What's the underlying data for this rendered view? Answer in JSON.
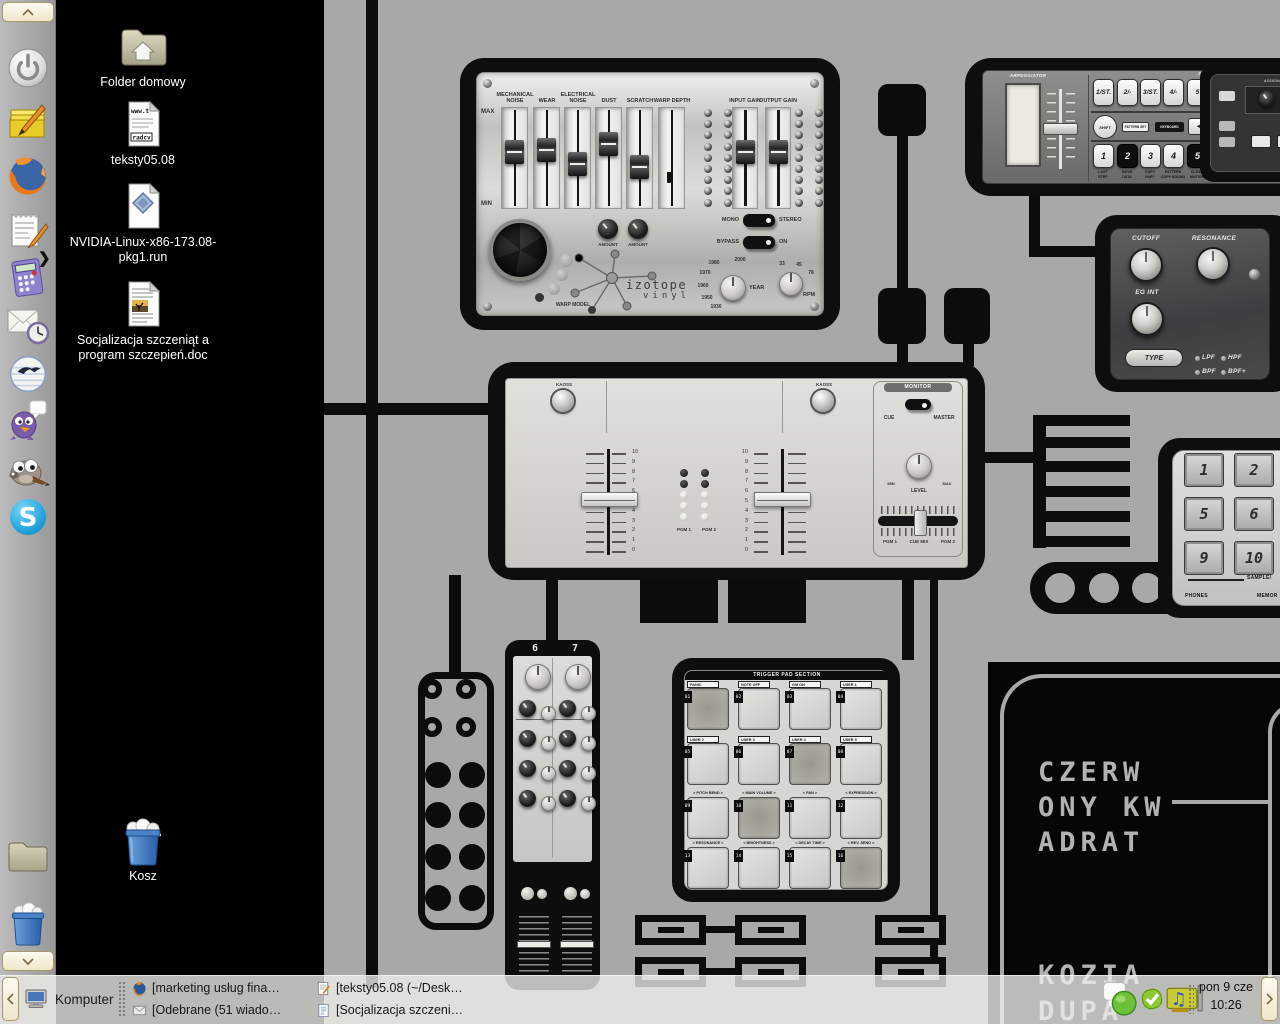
{
  "desktop": {
    "icons": [
      {
        "label": "Folder domowy",
        "icon": "folder-home-icon"
      },
      {
        "label": "teksty05.08",
        "icon": "text-file-icon",
        "preview_top": "www.t",
        "preview_bottom": "radcv"
      },
      {
        "label": "NVIDIA-Linux-x86-173.08-pkg1.run",
        "icon": "installer-file-icon"
      },
      {
        "label": "Socjalizacja szczeniąt a program szczepień.doc",
        "icon": "doc-file-icon"
      },
      {
        "label": "Kosz",
        "icon": "trash-full-icon"
      }
    ]
  },
  "side_panel": {
    "items": [
      {
        "icon": "power-icon"
      },
      {
        "icon": "sticky-notes-icon"
      },
      {
        "icon": "firefox-icon"
      },
      {
        "icon": "notepad-icon"
      },
      {
        "icon": "calculator-icon"
      },
      {
        "icon": "mail-clock-icon"
      },
      {
        "icon": "openoffice-icon"
      },
      {
        "icon": "pidgin-icon"
      },
      {
        "icon": "gimp-icon"
      },
      {
        "icon": "skype-icon"
      },
      {
        "icon": "folder-icon"
      },
      {
        "icon": "trash-icon"
      }
    ]
  },
  "taskbar": {
    "menu_label": "Komputer",
    "tasks": [
      {
        "icon": "firefox-icon",
        "label": "[marketing usług fina…"
      },
      {
        "icon": "editor-icon",
        "label": "[teksty05.08 (~/Desk…"
      },
      {
        "icon": "mail-icon",
        "label": "[Odebrane (51 wiado…"
      },
      {
        "icon": "document-icon",
        "label": "[Socjalizacja szczeni…"
      }
    ],
    "tray_icons": [
      "messenger-status-icon",
      "skype-status-icon",
      "soundcard-icon"
    ],
    "clock": {
      "date": "pon 9 cze",
      "time": "10:26"
    }
  },
  "wallpaper": {
    "vinyl": {
      "max_label": "MAX",
      "min_label": "MIN",
      "sliders": [
        {
          "label": "MECHANICAL NOISE",
          "pos": 44
        },
        {
          "label": "WEAR",
          "pos": 42
        },
        {
          "label": "ELECTRICAL NOISE",
          "pos": 56
        },
        {
          "label": "DUST",
          "pos": 36
        },
        {
          "label": "SCRATCH",
          "pos": 59
        },
        {
          "label": "WARP DEPTH",
          "pos": 64,
          "no_handle": true
        }
      ],
      "gain_sliders": [
        {
          "label": "INPUT GAIN",
          "pos": 44
        },
        {
          "label": "OUTPUT GAIN",
          "pos": 44
        }
      ],
      "mono_label": "MONO",
      "stereo_label": "STEREO",
      "bypass_label": "BYPASS",
      "on_label": "ON",
      "amount_label": "AMOUNT",
      "warp_model_label": "WARP MODEL",
      "logo_line1": "izotope",
      "logo_line2": "vinyl",
      "year": {
        "label": "YEAR",
        "ticks": [
          "1980",
          "2000",
          "1970",
          "1960",
          "1950",
          "1930"
        ]
      },
      "rpm": {
        "label": "RPM",
        "ticks": [
          "33",
          "45",
          "78"
        ]
      }
    },
    "arp": {
      "title": "ARPEGGIATOR",
      "drum_title": "DRUM PART",
      "top_buttons": [
        "1/ST.",
        "2/-",
        "3/ST.",
        "4/-",
        "5"
      ],
      "shift_label": "SHIFT",
      "pattern_set_label": "PATTERN SET",
      "keyboard_label": "KEYBOARD",
      "arrow_label": "◄",
      "num_buttons": [
        {
          "label": "1"
        },
        {
          "label": "2",
          "inverted": true
        },
        {
          "label": "3"
        },
        {
          "label": "4"
        },
        {
          "label": "5",
          "inverted": true
        }
      ],
      "bottom_labels": [
        [
          "LAST",
          "STEP"
        ],
        [
          "MOVE",
          "DATA"
        ],
        [
          "COPY",
          "PART"
        ],
        [
          "PATTERN",
          "COPY SOUND"
        ],
        [
          "CLEAR",
          "MOTION"
        ]
      ],
      "assignable_label": "ASSIGNABLE CONTROL"
    },
    "filter": {
      "cutoff_label": "CUTOFF",
      "resonance_label": "RESONANCE",
      "egint_label": "EG INT",
      "type_label": "TYPE",
      "modes": [
        "LPF",
        "HPF",
        "BPF",
        "BPF+"
      ]
    },
    "mixer": {
      "kaoss_label": "KAOSS",
      "scale": [
        "10",
        "9",
        "8",
        "7",
        "6",
        "5",
        "4",
        "3",
        "2",
        "1",
        "0"
      ],
      "pgm1_label": "PGM 1",
      "pgm2_label": "PGM 2",
      "monitor_label": "MONITOR",
      "cue_label": "CUE",
      "master_label": "MASTER",
      "level_label": "LEVEL",
      "min_label": "MIN",
      "max_label": "MAX",
      "xfade_left": "PGM 1",
      "xfade_mid": "CUE MIX",
      "xfade_right": "PGM 2"
    },
    "pads": {
      "title": "TRIGGER PAD SECTION",
      "items": [
        {
          "num": "01",
          "label": "PANIC",
          "boxed": true,
          "active": true
        },
        {
          "num": "02",
          "label": "NOTE OFF",
          "boxed": true
        },
        {
          "num": "03",
          "label": "GM ON",
          "boxed": true
        },
        {
          "num": "04",
          "label": "USER 1",
          "boxed": true
        },
        {
          "num": "05",
          "label": "USER 2",
          "boxed": true
        },
        {
          "num": "06",
          "label": "USER 3",
          "boxed": true
        },
        {
          "num": "07",
          "label": "USER 4",
          "boxed": true,
          "active": true
        },
        {
          "num": "08",
          "label": "USER 5",
          "boxed": true
        },
        {
          "num": "09",
          "label": "< PITCH BEND >"
        },
        {
          "num": "10",
          "label": "< MAIN VOLUME >",
          "active": true
        },
        {
          "num": "11",
          "label": "< PAN >"
        },
        {
          "num": "12",
          "label": "< EXPRESSION >"
        },
        {
          "num": "13",
          "label": "< RESONANCE >"
        },
        {
          "num": "14",
          "label": "< BRIGHTNESS >"
        },
        {
          "num": "15",
          "label": "< DECAY TIME >"
        },
        {
          "num": "16",
          "label": "< REV. SEND >",
          "active": true
        }
      ]
    },
    "sampler": {
      "keys": [
        "1",
        "2",
        "5",
        "6",
        "9",
        "10"
      ],
      "sample_label": "SAMPLE/",
      "phones_label": "PHONES",
      "memory_label": "MEMOR"
    },
    "strip": {
      "channels": [
        "6",
        "7"
      ]
    },
    "poster": {
      "lines": [
        "CZERW",
        "ONY KW",
        "ADRAT"
      ],
      "bottom_lines": [
        "KOZIA",
        "DUPA"
      ]
    }
  }
}
